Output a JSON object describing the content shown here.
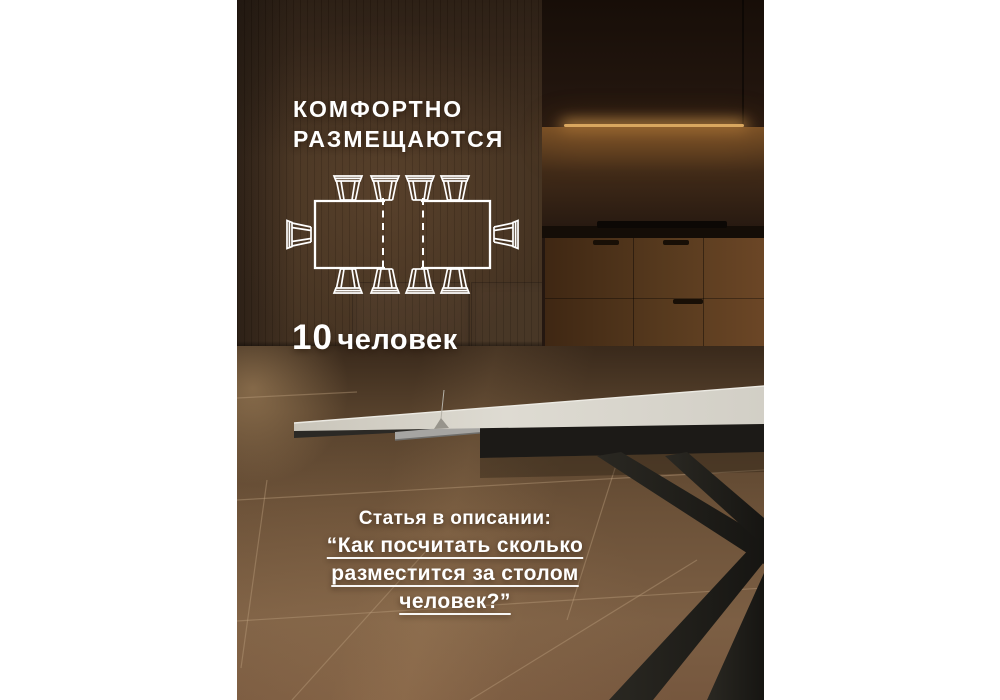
{
  "layout": {
    "canvas_width": 1000,
    "canvas_height": 700
  },
  "overlay": {
    "text_color": "#ffffff",
    "headline": {
      "line1": "КОМФОРТНО",
      "line2": "РАЗМЕЩАЮТСЯ"
    },
    "capacity": {
      "value": "10",
      "unit": "человек"
    },
    "footer": {
      "intro": "Статья в описании:",
      "quote_lines": [
        "“Как посчитать сколько",
        "разместится за столом",
        "человек?”"
      ]
    }
  },
  "diagram": {
    "name": "extendable-table-seating-plan",
    "stroke_color": "#ffffff",
    "seats_total": 10,
    "seats_long_side_each": 4,
    "seats_short_side_each": 1,
    "extension_marked_with": "dashed-lines"
  },
  "scene": {
    "margin_color": "#ffffff",
    "wall_color": "#42301f",
    "kitchen_dark": "#241710",
    "led_glow": "#d9a75f",
    "cabinet_wood": "#5a3a1e",
    "floor_brown": "#6b5138",
    "grout_line": "#bd9f7e",
    "tabletop_ceramic": "#d5d2c8",
    "table_frame_black": "#1c1a17",
    "bracket_metal": "#a6a5a2"
  }
}
